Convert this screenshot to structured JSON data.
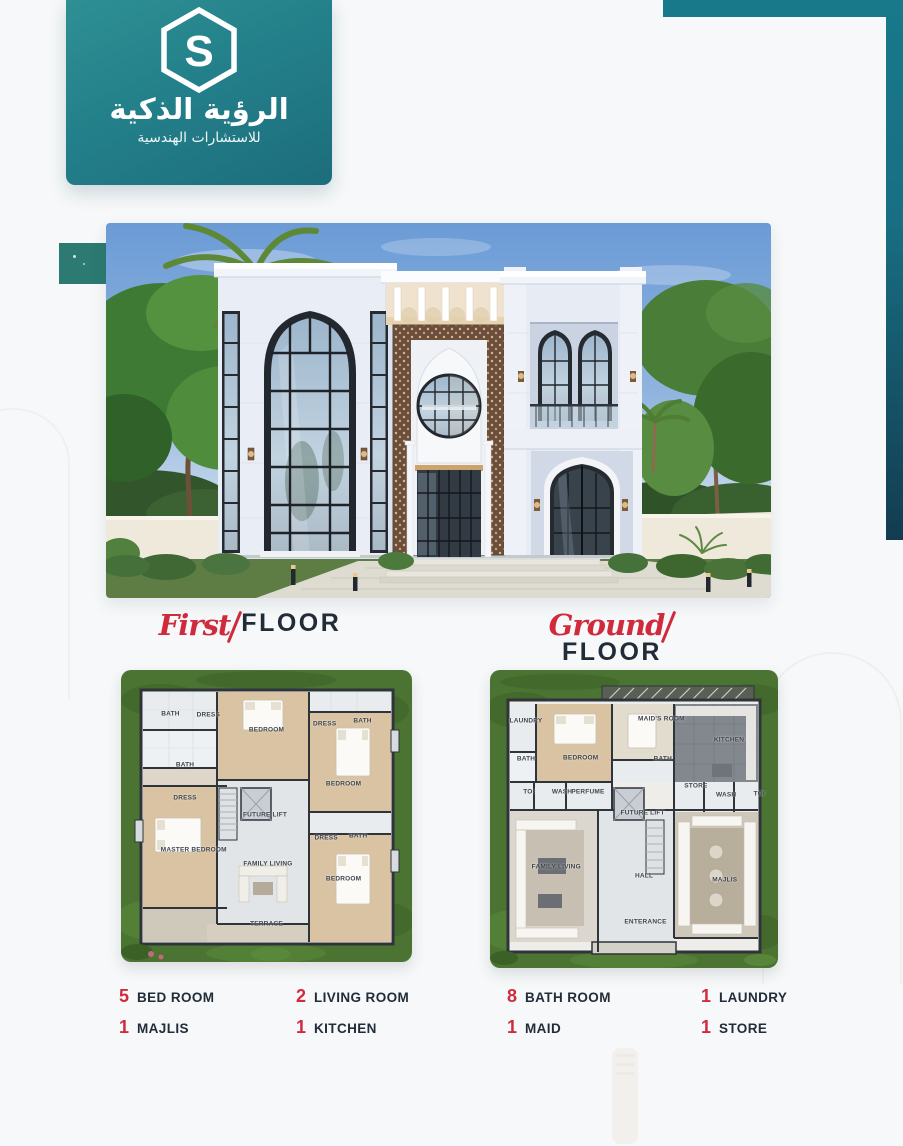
{
  "brand": {
    "name_ar": "الرؤية الذكية",
    "tagline_ar": "للاستشارات الهندسية",
    "logo_letter": "S",
    "teal": "#23808a",
    "teal_dark": "#1d6d7c"
  },
  "accent": {
    "red": "#cf2b3d",
    "navy": "#212c38"
  },
  "sections": {
    "first_floor": {
      "script": "First",
      "label": "FLOOR"
    },
    "ground_floor": {
      "script": "Ground",
      "label": "FLOOR"
    }
  },
  "plans": {
    "first": {
      "rooms": [
        {
          "label": "BATH",
          "x": 17,
          "y": 15
        },
        {
          "label": "DRESS",
          "x": 30,
          "y": 15.5
        },
        {
          "label": "BEDROOM",
          "x": 50,
          "y": 20.5
        },
        {
          "label": "DRESS",
          "x": 70,
          "y": 18.5
        },
        {
          "label": "BATH",
          "x": 83,
          "y": 17.5
        },
        {
          "label": "BATH",
          "x": 22,
          "y": 32.5
        },
        {
          "label": "DRESS",
          "x": 22,
          "y": 44
        },
        {
          "label": "BEDROOM",
          "x": 76.5,
          "y": 39
        },
        {
          "label": "FUTURE LIFT",
          "x": 49.5,
          "y": 49.5
        },
        {
          "label": "MASTER BEDROOM",
          "x": 25,
          "y": 61.5
        },
        {
          "label": "FAMILY LIVING",
          "x": 50.5,
          "y": 66.5
        },
        {
          "label": "DRESS",
          "x": 70.5,
          "y": 57.5
        },
        {
          "label": "BATH",
          "x": 81.5,
          "y": 57
        },
        {
          "label": "BEDROOM",
          "x": 76.5,
          "y": 71.5
        },
        {
          "label": "TERRACE",
          "x": 50,
          "y": 87
        }
      ]
    },
    "ground": {
      "rooms": [
        {
          "label": "LAUNDRY",
          "x": 12.5,
          "y": 17
        },
        {
          "label": "BEDROOM",
          "x": 31.5,
          "y": 29.5
        },
        {
          "label": "MAID'S ROOM",
          "x": 59.5,
          "y": 16.5
        },
        {
          "label": "KITCHEN",
          "x": 83,
          "y": 23.5
        },
        {
          "label": "BATH",
          "x": 12.5,
          "y": 30
        },
        {
          "label": "BATH",
          "x": 60,
          "y": 30
        },
        {
          "label": "TOI",
          "x": 13.5,
          "y": 41
        },
        {
          "label": "WASH",
          "x": 25,
          "y": 41
        },
        {
          "label": "PERFUME",
          "x": 34,
          "y": 41
        },
        {
          "label": "STORE",
          "x": 71.5,
          "y": 39
        },
        {
          "label": "WASH",
          "x": 82,
          "y": 42
        },
        {
          "label": "TOI",
          "x": 93.5,
          "y": 41.5
        },
        {
          "label": "FUTURE LIFT",
          "x": 53,
          "y": 48
        },
        {
          "label": "FAMILY LIVING",
          "x": 23,
          "y": 66
        },
        {
          "label": "HALL",
          "x": 53.5,
          "y": 69
        },
        {
          "label": "MAJLIS",
          "x": 81.5,
          "y": 70.5
        },
        {
          "label": "ENTERANCE",
          "x": 54,
          "y": 84.5
        }
      ]
    }
  },
  "features": [
    {
      "count": "5",
      "label": "BED ROOM"
    },
    {
      "count": "1",
      "label": "MAJLIS"
    },
    {
      "count": "2",
      "label": "LIVING ROOM"
    },
    {
      "count": "1",
      "label": "KITCHEN"
    },
    {
      "count": "8",
      "label": "BATH ROOM"
    },
    {
      "count": "1",
      "label": "MAID"
    },
    {
      "count": "1",
      "label": "LAUNDRY"
    },
    {
      "count": "1",
      "label": "STORE"
    }
  ]
}
